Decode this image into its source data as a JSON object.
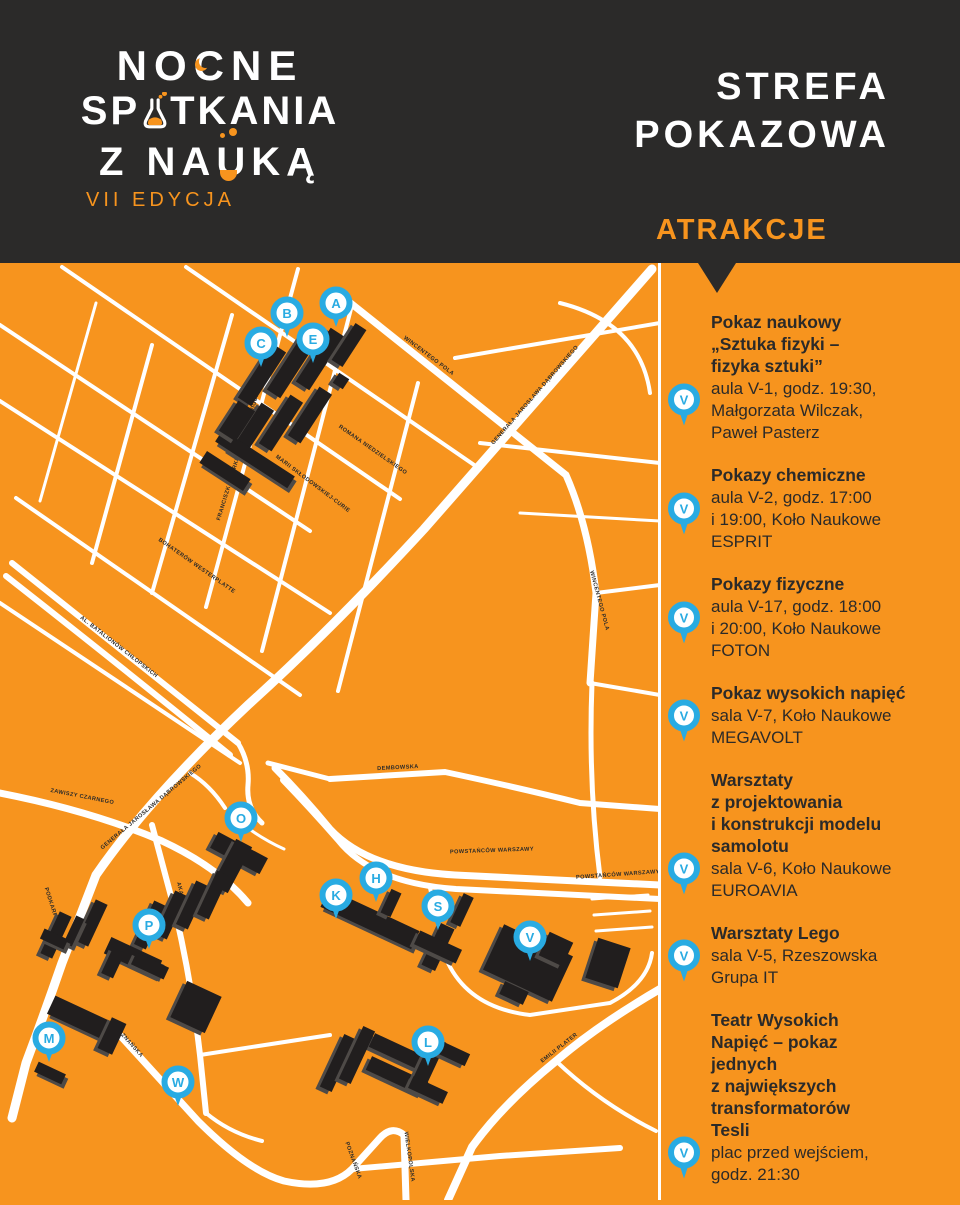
{
  "colors": {
    "orange": "#f7941e",
    "dark": "#2b2a29",
    "blue": "#29abe2",
    "white": "#ffffff",
    "building": "#211e1e",
    "building_shadow": "#4e4a47"
  },
  "header": {
    "logo_line1_a": "NO",
    "logo_line1_c": "C",
    "logo_line1_b": "NE",
    "logo_line2_a": "SP",
    "logo_line2_b": "TKANIA",
    "logo_line3_a": "Z NA",
    "logo_line3_u": "U",
    "logo_line3_b": "KĄ",
    "edition": "VII EDYCJA",
    "zone_line1": "STREFA",
    "zone_line2": "POKAZOWA",
    "section_label": "ATRAKCJE"
  },
  "attractions": [
    {
      "marker": "V",
      "title_lines": [
        "Pokaz naukowy",
        "„Sztuka fizyki –",
        "fizyka sztuki”"
      ],
      "detail_lines": [
        "aula V-1, godz. 19:30,",
        "Małgorzata Wilczak,",
        "Paweł Pasterz"
      ]
    },
    {
      "marker": "V",
      "title_lines": [
        "Pokazy chemiczne"
      ],
      "detail_lines": [
        "aula V-2, godz. 17:00",
        "i 19:00, Koło Naukowe",
        "ESPRIT"
      ]
    },
    {
      "marker": "V",
      "title_lines": [
        "Pokazy fizyczne"
      ],
      "detail_lines": [
        "aula V-17, godz. 18:00",
        "i 20:00, Koło Naukowe",
        "FOTON"
      ]
    },
    {
      "marker": "V",
      "title_lines": [
        "Pokaz wysokich napięć"
      ],
      "detail_lines": [
        "sala V-7, Koło Naukowe",
        "MEGAVOLT"
      ]
    },
    {
      "marker": "V",
      "title_lines": [
        "Warsztaty",
        "z projektowania",
        "i konstrukcji modelu",
        "samolotu"
      ],
      "detail_lines": [
        "sala V-6, Koło Naukowe",
        "EUROAVIA"
      ]
    },
    {
      "marker": "V",
      "title_lines": [
        "Warsztaty Lego"
      ],
      "detail_lines": [
        "sala V-5, Rzeszowska",
        "Grupa IT"
      ]
    },
    {
      "marker": "V",
      "title_lines": [
        "Teatr Wysokich",
        "Napięć – pokaz",
        "jednych",
        "z największych",
        "transformatorów",
        "Tesli"
      ],
      "detail_lines": [
        "plac przed wejściem,",
        "godz. 21:30"
      ]
    }
  ],
  "map": {
    "markers": [
      {
        "letter": "A",
        "x": 336,
        "y": 40
      },
      {
        "letter": "B",
        "x": 287,
        "y": 50
      },
      {
        "letter": "C",
        "x": 261,
        "y": 80
      },
      {
        "letter": "E",
        "x": 313,
        "y": 76
      },
      {
        "letter": "O",
        "x": 241,
        "y": 555
      },
      {
        "letter": "P",
        "x": 149,
        "y": 662
      },
      {
        "letter": "M",
        "x": 49,
        "y": 775
      },
      {
        "letter": "W",
        "x": 178,
        "y": 819
      },
      {
        "letter": "K",
        "x": 336,
        "y": 632
      },
      {
        "letter": "H",
        "x": 376,
        "y": 615
      },
      {
        "letter": "S",
        "x": 438,
        "y": 643
      },
      {
        "letter": "V",
        "x": 530,
        "y": 674
      },
      {
        "letter": "L",
        "x": 428,
        "y": 779
      }
    ],
    "roads": [
      {
        "d": "M652,6 L424,266 Q330,368 248,442 Q150,534 96,612 L62,700 Q44,752 26,800 L12,855",
        "w": 9
      },
      {
        "d": "M12,300 Q128,392 238,480",
        "w": 6
      },
      {
        "d": "M6,313 Q122,404 230,492",
        "w": 6
      },
      {
        "d": "M0,530 Q92,548 162,578 Q218,604 248,640",
        "w": 7
      },
      {
        "d": "M660,622 L455,612 Q368,607 330,566 Q302,532 275,505",
        "w": 7
      },
      {
        "d": "M660,636 L456,626 Q372,620 338,577 Q310,545 283,517",
        "w": 6
      },
      {
        "d": "M660,726 Q598,762 556,798 Q502,842 472,884 L448,937",
        "w": 8
      },
      {
        "d": "M116,768 L198,858 Q248,908 284,918 Q330,928 352,906 L380,875 Q392,862 404,872 L406,937",
        "w": 7
      },
      {
        "d": "M352,906 L500,893 L620,885",
        "w": 6
      },
      {
        "d": "M152,562 L176,652 Q192,722 200,792 L206,850",
        "w": 6
      },
      {
        "d": "M330,516 L445,509 Q520,525 580,540 L660,546",
        "w": 6
      },
      {
        "d": "M348,38 L566,212 Q588,262 596,330 L590,420",
        "w": 7
      },
      {
        "d": "M592,420 Q588,520 600,614",
        "w": 5
      },
      {
        "d": "M0,62 L310,268",
        "w": 4
      },
      {
        "d": "M0,138 L330,350",
        "w": 4
      },
      {
        "d": "M16,235 L300,432",
        "w": 4
      },
      {
        "d": "M0,340 L240,500",
        "w": 4
      },
      {
        "d": "M62,4 L400,236",
        "w": 4
      },
      {
        "d": "M186,4 L480,206",
        "w": 4
      },
      {
        "d": "M298,6 L206,344",
        "w": 4
      },
      {
        "d": "M352,42 L262,388",
        "w": 4
      },
      {
        "d": "M232,52 L152,330",
        "w": 4
      },
      {
        "d": "M152,82 L92,300",
        "w": 4
      },
      {
        "d": "M96,40 L40,238",
        "w": 3
      },
      {
        "d": "M418,120 L338,428",
        "w": 4
      },
      {
        "d": "M455,95 L660,60",
        "w": 4
      },
      {
        "d": "M480,180 L660,200",
        "w": 4
      },
      {
        "d": "M560,40 Q640,60 650,130",
        "w": 4
      },
      {
        "d": "M520,250 L660,258",
        "w": 3
      },
      {
        "d": "M596,330 L660,322",
        "w": 4
      },
      {
        "d": "M590,420 L660,432",
        "w": 4
      },
      {
        "d": "M238,480 Q250,500 248,522 Q246,545 262,560",
        "w": 5
      },
      {
        "d": "M190,510 Q210,522 225,545",
        "w": 4
      },
      {
        "d": "M268,500 L330,516",
        "w": 5
      },
      {
        "d": "M430,625 L448,700 Q470,745 530,752 L610,740 Q648,720 652,690",
        "w": 4
      },
      {
        "d": "M592,636 L648,632",
        "w": 3
      },
      {
        "d": "M594,652 L650,648",
        "w": 3
      },
      {
        "d": "M596,668 L652,664",
        "w": 3
      },
      {
        "d": "M206,850 Q230,870 262,878",
        "w": 4
      },
      {
        "d": "M200,792 L330,772",
        "w": 4
      },
      {
        "d": "M556,798 Q600,840 656,868",
        "w": 4
      },
      {
        "d": "M241,560 Q262,576 284,586",
        "w": 3
      }
    ],
    "road_labels": [
      {
        "text": "GENERAŁA JAROSŁAWA DĄBROWSKIEGO",
        "x": 536,
        "y": 133,
        "rot": -49
      },
      {
        "text": "GENERAŁA JAROSŁAWA DĄBROWSKIEGO",
        "x": 152,
        "y": 545,
        "rot": -40
      },
      {
        "text": "AL. BATALIONÓW CHŁOPSKICH",
        "x": 118,
        "y": 385,
        "rot": 38
      },
      {
        "text": "ZAWISZY CZARNEGO",
        "x": 82,
        "y": 535,
        "rot": 11
      },
      {
        "text": "PODKARPACKA",
        "x": 52,
        "y": 648,
        "rot": 72
      },
      {
        "text": "FRANCISZKA ŻWIRKI I STANISŁAWA WIGURY",
        "x": 240,
        "y": 192,
        "rot": -73
      },
      {
        "text": "MARII SKŁODOWSKIEJ-CURIE",
        "x": 312,
        "y": 222,
        "rot": 37
      },
      {
        "text": "BOHATERÓW WESTERPLATTE",
        "x": 196,
        "y": 304,
        "rot": 35
      },
      {
        "text": "ROMANA NIEDZIELSKIEGO",
        "x": 372,
        "y": 188,
        "rot": 35
      },
      {
        "text": "WINCENTEGO POLA",
        "x": 428,
        "y": 94,
        "rot": 37
      },
      {
        "text": "WINCENTEGO POLA",
        "x": 598,
        "y": 338,
        "rot": 75
      },
      {
        "text": "DEMBOWSKA",
        "x": 398,
        "y": 506,
        "rot": -3
      },
      {
        "text": "POWSTAŃCÓW WARSZAWY",
        "x": 492,
        "y": 589,
        "rot": -2
      },
      {
        "text": "POWSTAŃCÓW WARSZAWY",
        "x": 618,
        "y": 613,
        "rot": -4
      },
      {
        "text": "AKADEMICKA",
        "x": 182,
        "y": 640,
        "rot": 76
      },
      {
        "text": "POZNAŃSKA",
        "x": 128,
        "y": 780,
        "rot": 48
      },
      {
        "text": "POZNAŃSKA",
        "x": 352,
        "y": 898,
        "rot": 70
      },
      {
        "text": "WIELKOPOLSKA",
        "x": 408,
        "y": 894,
        "rot": 82
      },
      {
        "text": "EMILII PLATER",
        "x": 560,
        "y": 786,
        "rot": -38
      }
    ],
    "buildings": [
      [
        262,
        112,
        16,
        64,
        33
      ],
      [
        291,
        104,
        16,
        64,
        33
      ],
      [
        320,
        96,
        16,
        64,
        33
      ],
      [
        349,
        82,
        13,
        44,
        33
      ],
      [
        341,
        118,
        12,
        12,
        33
      ],
      [
        252,
        168,
        15,
        58,
        33
      ],
      [
        281,
        160,
        15,
        58,
        33
      ],
      [
        310,
        152,
        15,
        58,
        33
      ],
      [
        255,
        196,
        14,
        86,
        -57
      ],
      [
        225,
        208,
        14,
        52,
        -57
      ],
      [
        237,
        158,
        20,
        36,
        33
      ],
      [
        239,
        590,
        56,
        18,
        28
      ],
      [
        232,
        603,
        18,
        52,
        28
      ],
      [
        150,
        662,
        13,
        48,
        25
      ],
      [
        171,
        652,
        13,
        48,
        25
      ],
      [
        192,
        642,
        13,
        48,
        25
      ],
      [
        213,
        632,
        13,
        48,
        25
      ],
      [
        56,
        672,
        13,
        46,
        25
      ],
      [
        92,
        660,
        13,
        46,
        25
      ],
      [
        74,
        668,
        30,
        9,
        -65
      ],
      [
        54,
        676,
        11,
        26,
        -65
      ],
      [
        133,
        694,
        18,
        56,
        -65
      ],
      [
        150,
        703,
        36,
        13,
        25
      ],
      [
        113,
        700,
        13,
        28,
        25
      ],
      [
        82,
        756,
        20,
        68,
        -65
      ],
      [
        112,
        773,
        16,
        34,
        25
      ],
      [
        50,
        810,
        11,
        30,
        -65
      ],
      [
        196,
        744,
        38,
        40,
        25
      ],
      [
        370,
        656,
        20,
        100,
        -65
      ],
      [
        391,
        640,
        11,
        26,
        25
      ],
      [
        438,
        684,
        15,
        46,
        25
      ],
      [
        438,
        684,
        46,
        15,
        25
      ],
      [
        462,
        647,
        11,
        32,
        25
      ],
      [
        528,
        700,
        76,
        50,
        25
      ],
      [
        556,
        686,
        26,
        26,
        25
      ],
      [
        514,
        730,
        26,
        14,
        25
      ],
      [
        608,
        700,
        34,
        42,
        18
      ],
      [
        400,
        790,
        62,
        15,
        25
      ],
      [
        397,
        813,
        62,
        15,
        25
      ],
      [
        428,
        801,
        15,
        54,
        25
      ],
      [
        452,
        790,
        34,
        13,
        25
      ],
      [
        428,
        827,
        38,
        13,
        25
      ],
      [
        338,
        800,
        13,
        58,
        25
      ],
      [
        357,
        792,
        13,
        58,
        25
      ]
    ]
  }
}
